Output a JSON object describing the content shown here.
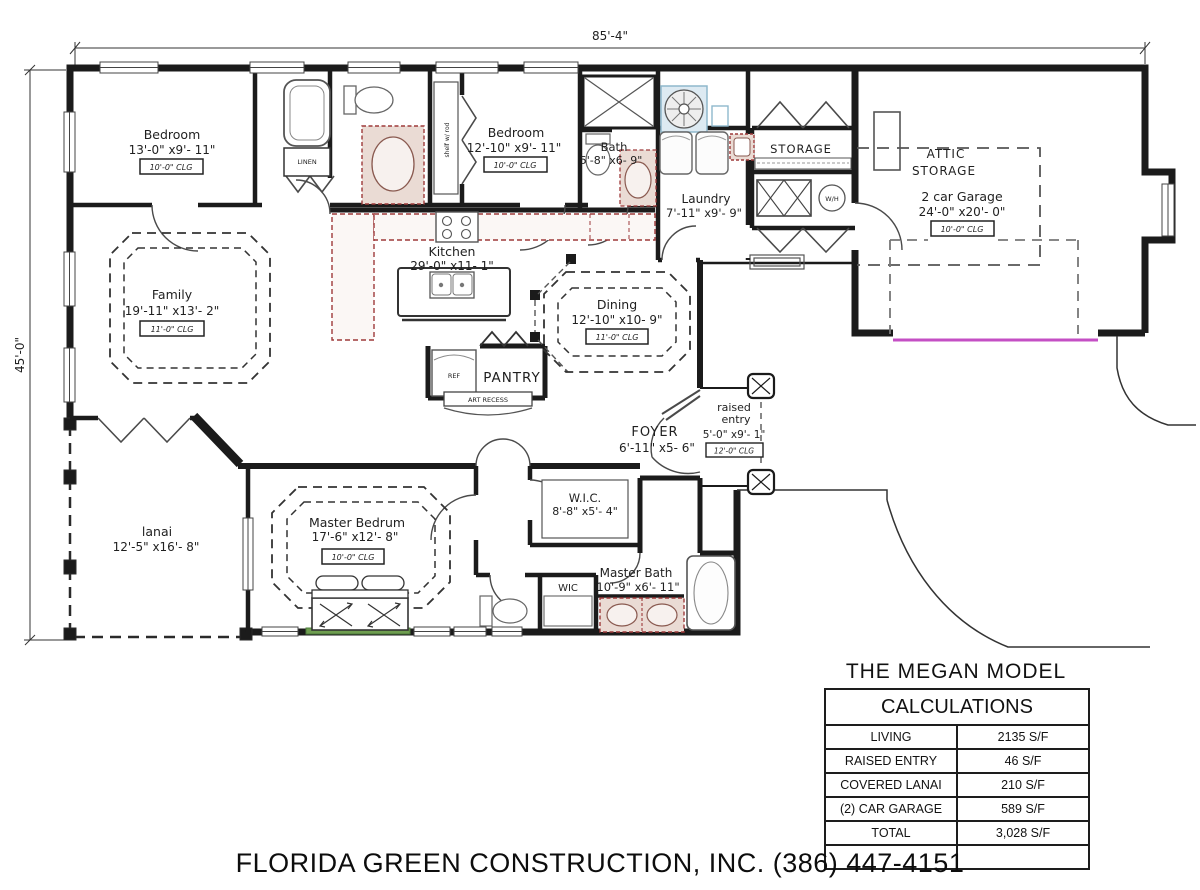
{
  "title": "THE MEGAN MODEL",
  "footer": "FLORIDA GREEN CONSTRUCTION, INC. (386) 447-4151",
  "plan": {
    "dimensions": {
      "overall_width": "85'-4\"",
      "overall_height": "45'-0\""
    },
    "rooms": {
      "bedroom1": {
        "name": "Bedroom",
        "size": "13'-0\" x9'- 11\"",
        "clg": "10'-0\" CLG"
      },
      "bedroom2": {
        "name": "Bedroom",
        "size": "12'-10\" x9'- 11\"",
        "clg": "10'-0\" CLG"
      },
      "bath": {
        "name": "Bath",
        "size": "5'-8\" x6- 9\""
      },
      "laundry": {
        "name": "Laundry",
        "size": "7'-11\" x9'- 9\""
      },
      "storage": {
        "name": "STORAGE"
      },
      "attic": {
        "line1": "ATTIC",
        "line2": "STORAGE"
      },
      "garage": {
        "name": "2 car Garage",
        "size": "24'-0\" x20'- 0\"",
        "clg": "10'-0\" CLG"
      },
      "family": {
        "name": "Family",
        "size": "19'-11\" x13'- 2\"",
        "clg": "11'-0\" CLG"
      },
      "kitchen": {
        "name": "Kitchen",
        "size": "29'-0\" x11- 1\""
      },
      "dining": {
        "name": "Dining",
        "size": "12'-10\" x10- 9\"",
        "clg": "11'-0\" CLG"
      },
      "pantry": {
        "name": "PANTRY"
      },
      "foyer": {
        "name": "FOYER",
        "size": "6'-11\" x5- 6\""
      },
      "entry": {
        "line1": "raised",
        "line2": "entry",
        "size": "5'-0\" x9'- 1\"",
        "clg": "12'-0\" CLG"
      },
      "lanai": {
        "name": "lanai",
        "size": "12'-5\" x16'- 8\""
      },
      "master": {
        "name": "Master Bedrum",
        "size": "17'-6\" x12'- 8\"",
        "clg": "10'-0\" CLG"
      },
      "wic": {
        "name": "W.I.C.",
        "size": "8'-8\" x5'- 4\""
      },
      "wic2": {
        "name": "WIC"
      },
      "masterbath": {
        "name": "Master Bath",
        "size": "10'-9\" x6'- 11\""
      }
    },
    "annotations": {
      "water_heater": "W/H",
      "linen": "LINEN",
      "shelf": "shelf w/ rod",
      "ref": "REF",
      "art_recess": "ART RECESS"
    }
  },
  "calc_table": {
    "header": "CALCULATIONS",
    "rows": [
      {
        "label": "LIVING",
        "value": "2135 S/F"
      },
      {
        "label": "RAISED ENTRY",
        "value": "46 S/F"
      },
      {
        "label": "COVERED LANAI",
        "value": "210 S/F"
      },
      {
        "label": "(2) CAR GARAGE",
        "value": "589 S/F"
      },
      {
        "label": "TOTAL",
        "value": "3,028 S/F"
      },
      {
        "label": "",
        "value": ""
      }
    ]
  },
  "colors": {
    "wall": "#1b1b1b",
    "counter_outline": "#9e3a3a",
    "counter_fill": "#eadbd4",
    "garage_door": "#c44fc4",
    "window_sill_accent": "#6f9e50",
    "hvac_accent": "#8fb8cc"
  }
}
